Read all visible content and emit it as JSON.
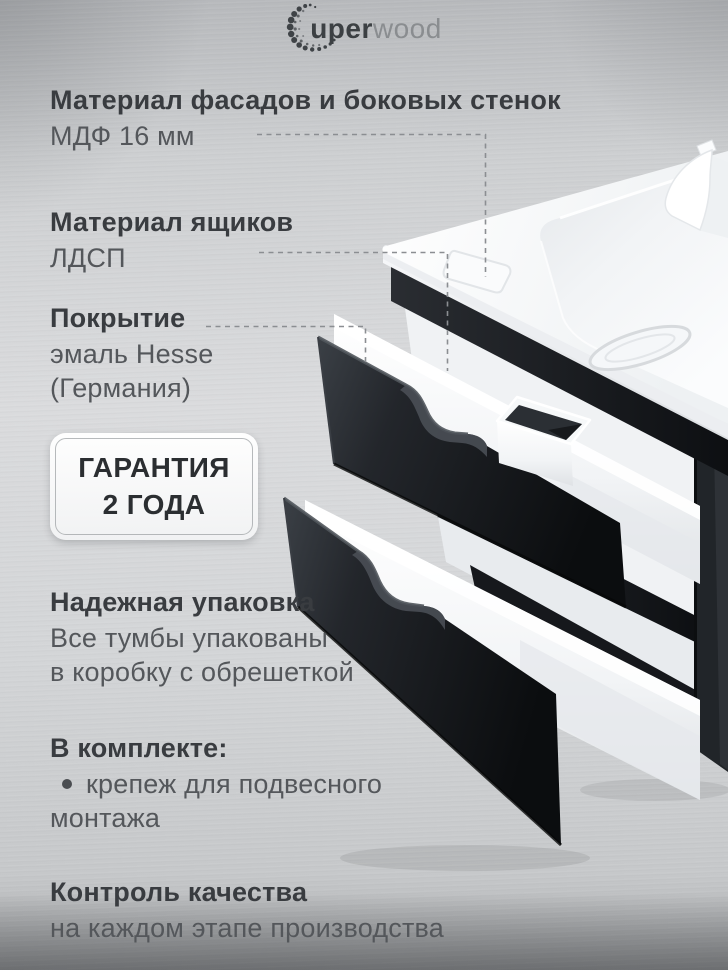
{
  "brand": {
    "logo_bold": "uper",
    "logo_light": "wood"
  },
  "features": {
    "facade": {
      "title": "Материал фасадов и боковых стенок",
      "value": "МДФ 16 мм"
    },
    "drawers": {
      "title": "Материал ящиков",
      "value": "ЛДСП"
    },
    "coating": {
      "title": "Покрытие",
      "line1": "эмаль Hesse",
      "line2": "(Германия)"
    },
    "packaging": {
      "title": "Надежная упаковка",
      "line1": "Все тумбы упакованы",
      "line2": "в коробку с обрешеткой"
    },
    "included": {
      "title": "В комплекте:",
      "item_line1": "крепеж для подвесного",
      "item_line2": "монтажа"
    },
    "quality": {
      "title": "Контроль качества",
      "value": "на каждом этапе производства"
    }
  },
  "warranty": {
    "line1": "ГАРАНТИЯ",
    "line2": "2 ГОДА"
  },
  "colors": {
    "heading_text": "#393c40",
    "body_text": "#54575b",
    "cabinet_black": "#17191c",
    "counter_white": "#fbfcfd",
    "background_metal": "#cfd1d3",
    "callout_line": "#8b8e92"
  }
}
